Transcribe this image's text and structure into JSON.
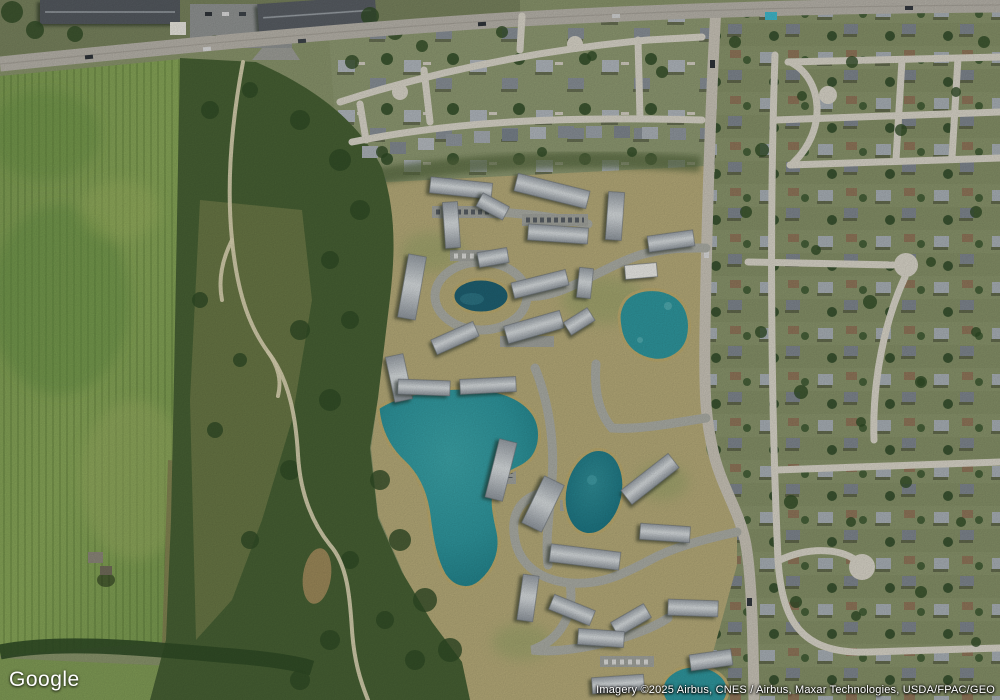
{
  "app": {
    "title": "Satellite map view"
  },
  "branding": {
    "logo_text": "Google"
  },
  "attribution": {
    "text": "Imagery ©2025 Airbus, CNES / Airbus, Maxar Technologies, USDA/FPAC/GEO"
  },
  "map": {
    "view_mode": "satellite",
    "features": [
      "agricultural field",
      "wooded corridor with walking trails",
      "apartment complex with retention ponds",
      "large teal pond",
      "suburban neighborhoods",
      "main north-south road",
      "highway along top edge"
    ],
    "colors": {
      "field_green": "#7c9a52",
      "field_dark": "#5e8a3e",
      "forest": "#465f33",
      "forest_dark": "#2f4a25",
      "scrub": "#6f7a48",
      "dry_grass": "#b3a877",
      "suburb_ground": "#87926a",
      "road_major": "#b4b0a7",
      "road_minor": "#d6d2c6",
      "asphalt": "#a8aaa2",
      "trail": "#d8d0b0",
      "roof_dark": "#53585e",
      "water_teal": "#2e949b",
      "water_dark": "#1e7b84",
      "mud_pond": "#9a8758"
    }
  }
}
